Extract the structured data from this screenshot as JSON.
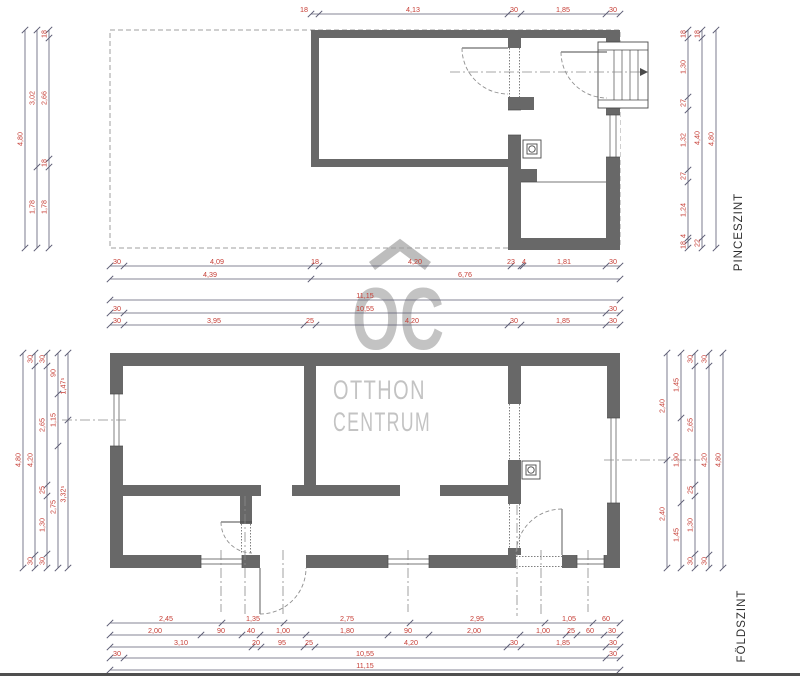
{
  "floor_labels": {
    "upper": "PINCESZINT",
    "lower": "FÖLDSZINT"
  },
  "watermark": {
    "monogram": "OC",
    "line1": "OTTHON",
    "line2": "CENTRUM",
    "color": "#c3c3c3"
  },
  "colors": {
    "wall": "#686868",
    "dim_text": "#c63d35",
    "dim_line": "#5b5b73",
    "thin_line": "#4a4a4a",
    "footprint_dash": "#9f9f9f"
  },
  "stair_icon": "stair-arrow-right",
  "dimensions": [
    {
      "axis": "h",
      "pos": 14,
      "from": 311,
      "to": 620,
      "ticks": [
        311,
        319,
        508,
        521,
        606,
        620
      ],
      "labels": [
        [
          "18",
          304
        ],
        [
          "4,13",
          413
        ],
        [
          "30",
          514
        ],
        [
          "1,85",
          563
        ],
        [
          "30",
          613
        ]
      ]
    },
    {
      "axis": "h",
      "pos": 266,
      "from": 110,
      "to": 620,
      "ticks": [
        110,
        124,
        311,
        319,
        511,
        521,
        523,
        606,
        620
      ],
      "labels": [
        [
          "30",
          117
        ],
        [
          "4,09",
          217
        ],
        [
          "18",
          315
        ],
        [
          "4,20",
          415
        ],
        [
          "23",
          511
        ],
        [
          "4",
          524
        ],
        [
          "1,81",
          564
        ],
        [
          "30",
          613
        ]
      ]
    },
    {
      "axis": "h",
      "pos": 279,
      "from": 110,
      "to": 620,
      "ticks": [
        110,
        311,
        620
      ],
      "labels": [
        [
          "4,39",
          210
        ],
        [
          "6,76",
          465
        ]
      ]
    },
    {
      "axis": "h",
      "pos": 300,
      "from": 110,
      "to": 620,
      "ticks": [
        110,
        620
      ],
      "labels": [
        [
          "11,15",
          365
        ]
      ]
    },
    {
      "axis": "h",
      "pos": 313,
      "from": 110,
      "to": 620,
      "ticks": [
        110,
        124,
        606,
        620
      ],
      "labels": [
        [
          "30",
          117
        ],
        [
          "10,55",
          365
        ],
        [
          "30",
          613
        ]
      ]
    },
    {
      "axis": "v",
      "pos": 25,
      "from": 30,
      "to": 248,
      "ticks": [
        30,
        248
      ],
      "labels": [
        [
          "4,80",
          139
        ]
      ]
    },
    {
      "axis": "v",
      "pos": 37,
      "from": 30,
      "to": 248,
      "ticks": [
        30,
        167,
        248
      ],
      "labels": [
        [
          "3,02",
          98
        ],
        [
          "1,78",
          207
        ]
      ]
    },
    {
      "axis": "v",
      "pos": 49,
      "from": 30,
      "to": 248,
      "ticks": [
        30,
        38,
        159,
        167,
        248
      ],
      "labels": [
        [
          "18",
          34
        ],
        [
          "2,66",
          98
        ],
        [
          "18",
          163
        ],
        [
          "1,78",
          207
        ]
      ]
    },
    {
      "axis": "v",
      "pos": 688,
      "from": 30,
      "to": 248,
      "ticks": [
        30,
        38,
        97,
        110,
        170,
        182,
        238,
        241,
        248
      ],
      "labels": [
        [
          "18",
          34
        ],
        [
          "1,30",
          67
        ],
        [
          "27",
          103
        ],
        [
          "1,32",
          140
        ],
        [
          "27",
          176
        ],
        [
          "1,24",
          210
        ],
        [
          "4",
          236
        ],
        [
          "18",
          245
        ]
      ]
    },
    {
      "axis": "v",
      "pos": 702,
      "from": 30,
      "to": 248,
      "ticks": [
        30,
        38,
        238,
        248
      ],
      "labels": [
        [
          "18",
          34
        ],
        [
          "4,40",
          138
        ],
        [
          "22",
          243
        ]
      ]
    },
    {
      "axis": "v",
      "pos": 716,
      "from": 30,
      "to": 248,
      "ticks": [
        30,
        248
      ],
      "labels": [
        [
          "4,80",
          139
        ]
      ]
    },
    {
      "axis": "h",
      "pos": 325,
      "from": 110,
      "to": 620,
      "ticks": [
        110,
        124,
        304,
        316,
        508,
        521,
        606,
        620
      ],
      "labels": [
        [
          "30",
          117
        ],
        [
          "3,95",
          214
        ],
        [
          "25",
          310
        ],
        [
          "4,20",
          412
        ],
        [
          "30",
          514
        ],
        [
          "1,85",
          563
        ],
        [
          "30",
          613
        ]
      ]
    },
    {
      "axis": "v",
      "pos": 23,
      "from": 353,
      "to": 568,
      "ticks": [
        353,
        568
      ],
      "labels": [
        [
          "4,80",
          460
        ]
      ]
    },
    {
      "axis": "v",
      "pos": 35,
      "from": 353,
      "to": 568,
      "ticks": [
        353,
        366,
        555,
        568
      ],
      "labels": [
        [
          "30",
          359
        ],
        [
          "4,20",
          460
        ],
        [
          "30",
          561
        ]
      ]
    },
    {
      "axis": "v",
      "pos": 47,
      "from": 353,
      "to": 568,
      "ticks": [
        353,
        366,
        485,
        496,
        554,
        568
      ],
      "labels": [
        [
          "30",
          359
        ],
        [
          "2,65",
          425
        ],
        [
          "25",
          490
        ],
        [
          "1,30",
          525
        ],
        [
          "30",
          561
        ]
      ]
    },
    {
      "axis": "v",
      "pos": 58,
      "from": 353,
      "to": 568,
      "ticks": [
        353,
        394,
        446,
        568
      ],
      "labels": [
        [
          "90",
          373
        ],
        [
          "1,15",
          420
        ],
        [
          "2,75",
          507
        ]
      ]
    },
    {
      "axis": "v",
      "pos": 68,
      "from": 353,
      "to": 568,
      "ticks": [
        353,
        420,
        568
      ],
      "labels": [
        [
          "1,47⁵",
          386
        ],
        [
          "3,32⁵",
          494
        ]
      ]
    },
    {
      "axis": "v",
      "pos": 667,
      "from": 353,
      "to": 568,
      "ticks": [
        353,
        460,
        568
      ],
      "labels": [
        [
          "2,40",
          406
        ],
        [
          "2,40",
          514
        ]
      ]
    },
    {
      "axis": "v",
      "pos": 681,
      "from": 353,
      "to": 568,
      "ticks": [
        353,
        418,
        503,
        568
      ],
      "labels": [
        [
          "1,45",
          385
        ],
        [
          "1,90",
          460
        ],
        [
          "1,45",
          535
        ]
      ]
    },
    {
      "axis": "v",
      "pos": 695,
      "from": 353,
      "to": 568,
      "ticks": [
        353,
        366,
        485,
        496,
        554,
        568
      ],
      "labels": [
        [
          "30",
          359
        ],
        [
          "2,65",
          425
        ],
        [
          "25",
          490
        ],
        [
          "1,30",
          525
        ],
        [
          "30",
          561
        ]
      ]
    },
    {
      "axis": "v",
      "pos": 709,
      "from": 353,
      "to": 568,
      "ticks": [
        353,
        366,
        555,
        568
      ],
      "labels": [
        [
          "30",
          359
        ],
        [
          "4,20",
          460
        ],
        [
          "30",
          561
        ]
      ]
    },
    {
      "axis": "v",
      "pos": 723,
      "from": 353,
      "to": 568,
      "ticks": [
        353,
        568
      ],
      "labels": [
        [
          "4,80",
          460
        ]
      ]
    },
    {
      "axis": "h",
      "pos": 623,
      "from": 110,
      "to": 620,
      "ticks": [
        110,
        222,
        284,
        410,
        545,
        593,
        620
      ],
      "labels": [
        [
          "2,45",
          166
        ],
        [
          "1,35",
          253
        ],
        [
          "2,75",
          347
        ],
        [
          "2,95",
          477
        ],
        [
          "1,05",
          569
        ],
        [
          "60",
          606
        ]
      ]
    },
    {
      "axis": "h",
      "pos": 635,
      "from": 110,
      "to": 620,
      "ticks": [
        110,
        201,
        242,
        260,
        306,
        388,
        429,
        520,
        566,
        577,
        604,
        620
      ],
      "labels": [
        [
          "2,00",
          155
        ],
        [
          "90",
          221
        ],
        [
          "40",
          251
        ],
        [
          "1,00",
          283
        ],
        [
          "1,80",
          347
        ],
        [
          "90",
          408
        ],
        [
          "2,00",
          474
        ],
        [
          "1,00",
          543
        ],
        [
          "25",
          571
        ],
        [
          "60",
          590
        ],
        [
          "30",
          612
        ]
      ]
    },
    {
      "axis": "h",
      "pos": 647,
      "from": 110,
      "to": 620,
      "ticks": [
        110,
        252,
        261,
        304,
        315,
        507,
        521,
        606,
        620
      ],
      "labels": [
        [
          "3,10",
          181
        ],
        [
          "20",
          256
        ],
        [
          "95",
          282
        ],
        [
          "25",
          309
        ],
        [
          "4,20",
          411
        ],
        [
          "30",
          514
        ],
        [
          "1,85",
          563
        ],
        [
          "30",
          613
        ]
      ]
    },
    {
      "axis": "h",
      "pos": 658,
      "from": 110,
      "to": 620,
      "ticks": [
        110,
        124,
        606,
        620
      ],
      "labels": [
        [
          "30",
          117
        ],
        [
          "10,55",
          365
        ],
        [
          "30",
          613
        ]
      ]
    },
    {
      "axis": "h",
      "pos": 670,
      "from": 110,
      "to": 620,
      "ticks": [
        110,
        620
      ],
      "labels": [
        [
          "11,15",
          365
        ]
      ]
    }
  ]
}
